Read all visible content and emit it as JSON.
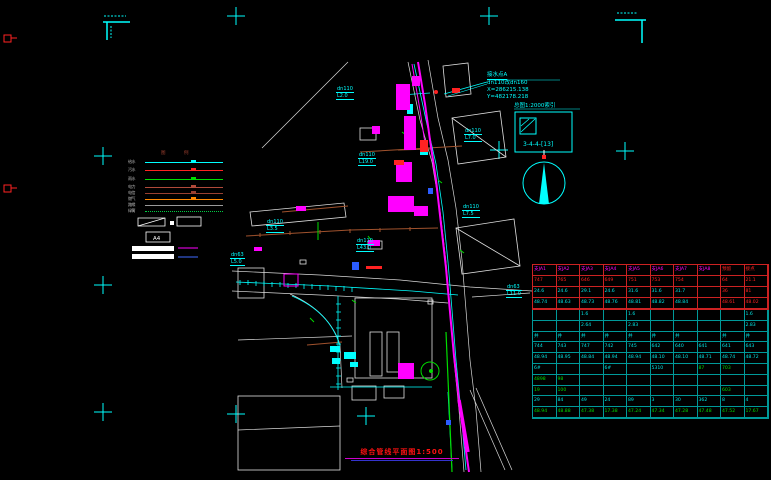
{
  "drawing": {
    "title": "综合管线平面图1:500",
    "scale": "1:500"
  },
  "annotation": {
    "line1": "接水点A",
    "line2": "dn110改dn160",
    "line3": "X=286215.138",
    "line4": "Y=482178.218"
  },
  "detail_box": {
    "title": "总图1:2000索引",
    "label": "3-4-4-[13]"
  },
  "legend": {
    "col1": "图",
    "col2": "例",
    "a4": "A4",
    "rows": [
      {
        "label": "给水",
        "color": "#00ffff",
        "style": "solid"
      },
      {
        "label": "污水",
        "color": "#ff2222",
        "style": "solid"
      },
      {
        "label": "雨水",
        "color": "#00dd00",
        "style": "solid"
      },
      {
        "label": "电力",
        "color": "#b04a3a",
        "style": "solid"
      },
      {
        "label": "电信",
        "color": "#9a4030",
        "style": "solid"
      },
      {
        "label": "燃气",
        "color": "#ff8800",
        "style": "solid"
      },
      {
        "label": "路缘",
        "color": "#9a9a9a",
        "style": "solid"
      },
      {
        "label": "绿篱",
        "color": "#00cc44",
        "style": "dotted"
      }
    ]
  },
  "pipe_labels": [
    {
      "l1": "dn63",
      "l2": "L5.0",
      "x": 230,
      "y": 252
    },
    {
      "l1": "dn110",
      "l2": "L3.5",
      "x": 266,
      "y": 219
    },
    {
      "l1": "dn110",
      "l2": "L43.0",
      "x": 356,
      "y": 238
    },
    {
      "l1": "dn110",
      "l2": "L19.0",
      "x": 358,
      "y": 152
    },
    {
      "l1": "dn110",
      "l2": "L2.0",
      "x": 336,
      "y": 86
    },
    {
      "l1": "dn110",
      "l2": "L7.0",
      "x": 464,
      "y": 128
    },
    {
      "l1": "dn110",
      "l2": "L7.5",
      "x": 462,
      "y": 204
    },
    {
      "l1": "dn63",
      "l2": "L11.0",
      "x": 506,
      "y": 284
    }
  ],
  "table": {
    "sections": [
      {
        "name": "table-section-a",
        "rows": [
          [
            [
              "支JA1",
              "m"
            ],
            [
              "支JA2",
              "m"
            ],
            [
              "支JA3",
              "m"
            ],
            [
              "支JA4",
              "m"
            ],
            [
              "支JA5",
              "m"
            ],
            [
              "支JA6",
              "m"
            ],
            [
              "支JA7",
              "m"
            ],
            [
              "支JA8",
              "m"
            ],
            [
              "预留",
              "r"
            ],
            [
              "接点",
              "r"
            ]
          ],
          [
            [
              "747",
              "r"
            ],
            [
              "765",
              "r"
            ],
            [
              "646",
              "r"
            ],
            [
              "649",
              "r"
            ],
            [
              "751",
              "r"
            ],
            [
              "753",
              "r"
            ],
            [
              "754",
              "r"
            ],
            [
              "",
              "r"
            ],
            [
              "64",
              "r"
            ],
            [
              "21.1",
              "r"
            ]
          ],
          [
            [
              "24.6",
              "c"
            ],
            [
              "24.6",
              "c"
            ],
            [
              "29.1",
              "c"
            ],
            [
              "24.6",
              "c"
            ],
            [
              "31.6",
              "c"
            ],
            [
              "31.6",
              "c"
            ],
            [
              "31.7",
              "c"
            ],
            [
              "",
              "c"
            ],
            [
              "36",
              "r"
            ],
            [
              "81",
              "r"
            ]
          ],
          [
            [
              "48.74",
              "c"
            ],
            [
              "48.63",
              "c"
            ],
            [
              "48.73",
              "c"
            ],
            [
              "48.76",
              "c"
            ],
            [
              "48.81",
              "c"
            ],
            [
              "48.82",
              "c"
            ],
            [
              "48.84",
              "c"
            ],
            [
              "",
              "c"
            ],
            [
              "48.61",
              "r"
            ],
            [
              "48.02",
              "r"
            ]
          ]
        ]
      },
      {
        "name": "table-section-b",
        "rows": [
          [
            [
              "",
              "c"
            ],
            [
              "",
              "c"
            ],
            [
              "1.6",
              "c"
            ],
            [
              "",
              "c"
            ],
            [
              "1.6",
              "c"
            ],
            [
              "",
              "c"
            ],
            [
              "",
              "c"
            ],
            [
              "",
              "c"
            ],
            [
              "",
              "c"
            ],
            [
              "1.6",
              "c"
            ]
          ],
          [
            [
              "",
              "c"
            ],
            [
              "",
              "c"
            ],
            [
              "2.64",
              "c"
            ],
            [
              "",
              "c"
            ],
            [
              "2.83",
              "c"
            ],
            [
              "",
              "c"
            ],
            [
              "",
              "c"
            ],
            [
              "",
              "c"
            ],
            [
              "",
              "c"
            ],
            [
              "2.83",
              "c"
            ]
          ],
          [
            [
              "井",
              "c"
            ],
            [
              "井",
              "c"
            ],
            [
              "井",
              "c"
            ],
            [
              "井",
              "c"
            ],
            [
              "井",
              "c"
            ],
            [
              "井",
              "c"
            ],
            [
              "井",
              "c"
            ],
            [
              "",
              "c"
            ],
            [
              "井",
              "c"
            ],
            [
              "井",
              "c"
            ]
          ],
          [
            [
              "744",
              "c"
            ],
            [
              "743",
              "c"
            ],
            [
              "747",
              "c"
            ],
            [
              "742",
              "c"
            ],
            [
              "745",
              "c"
            ],
            [
              "642",
              "c"
            ],
            [
              "640",
              "c"
            ],
            [
              "641",
              "c"
            ],
            [
              "641",
              "c"
            ],
            [
              "643",
              "c"
            ]
          ],
          [
            [
              "48.94",
              "c"
            ],
            [
              "48.95",
              "c"
            ],
            [
              "48.84",
              "c"
            ],
            [
              "48.94",
              "c"
            ],
            [
              "48.94",
              "c"
            ],
            [
              "48.10",
              "c"
            ],
            [
              "48.10",
              "c"
            ],
            [
              "48.71",
              "c"
            ],
            [
              "48.74",
              "c"
            ],
            [
              "48.72",
              "c"
            ]
          ],
          [
            [
              "6#",
              "c"
            ],
            [
              "",
              "c"
            ],
            [
              "",
              "c"
            ],
            [
              "6#",
              "c"
            ],
            [
              "",
              "c"
            ],
            [
              "5310",
              "c"
            ],
            [
              "",
              "c"
            ],
            [
              "87",
              "g"
            ],
            [
              "703",
              "g"
            ],
            [
              "",
              "c"
            ]
          ],
          [
            [
              "4898",
              "g"
            ],
            [
              "98",
              "g"
            ],
            [
              "",
              "g"
            ],
            [
              "",
              "g"
            ],
            [
              "",
              "g"
            ],
            [
              "",
              "g"
            ],
            [
              "",
              "g"
            ],
            [
              "",
              "g"
            ],
            [
              "",
              "g"
            ],
            [
              "",
              "g"
            ]
          ],
          [
            [
              "19",
              "g"
            ],
            [
              "100",
              "g"
            ],
            [
              "",
              "g"
            ],
            [
              "",
              "g"
            ],
            [
              "",
              "g"
            ],
            [
              "",
              "g"
            ],
            [
              "",
              "g"
            ],
            [
              "",
              "g"
            ],
            [
              "603",
              "g"
            ],
            [
              "",
              "g"
            ]
          ],
          [
            [
              "29",
              "c"
            ],
            [
              "84",
              "c"
            ],
            [
              "49",
              "c"
            ],
            [
              "24",
              "c"
            ],
            [
              "89",
              "c"
            ],
            [
              "3",
              "c"
            ],
            [
              "30",
              "c"
            ],
            [
              "362",
              "c"
            ],
            [
              "8",
              "c"
            ],
            [
              "4",
              "c"
            ]
          ],
          [
            [
              "48.94",
              "g"
            ],
            [
              "48.88",
              "g"
            ],
            [
              "47.38",
              "g"
            ],
            [
              "17.38",
              "g"
            ],
            [
              "47.24",
              "g"
            ],
            [
              "47.34",
              "g"
            ],
            [
              "47.28",
              "g"
            ],
            [
              "47.48",
              "g"
            ],
            [
              "47.52",
              "g"
            ],
            [
              "17.67",
              "g"
            ]
          ]
        ]
      }
    ]
  },
  "colors": {
    "background": "#000000",
    "water_main": "#ff00ff",
    "pipe": "#00ffff",
    "green_line": "#00dd00",
    "red_text": "#ff2222",
    "maroon_line": "#a0522d",
    "table_border_top": "#cc2222",
    "table_border_bottom": "#009999"
  }
}
